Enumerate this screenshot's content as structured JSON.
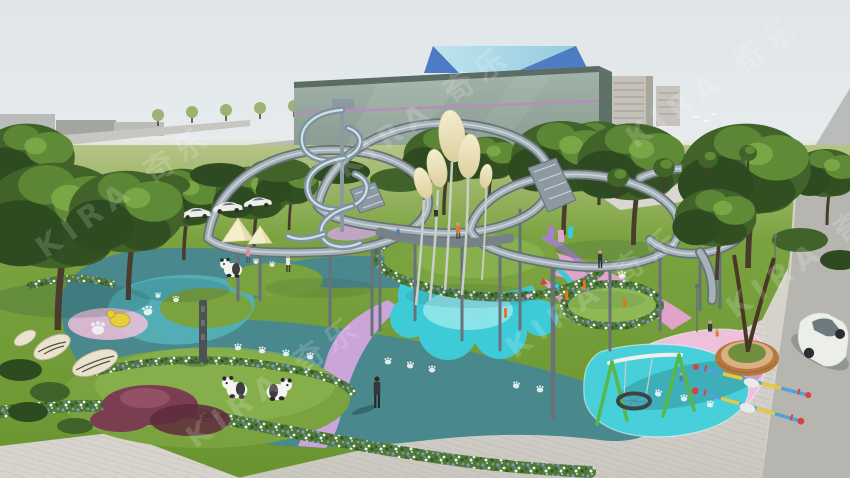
{
  "scene": {
    "type": "3d-architectural-rendering",
    "subject": "Panda-themed children's playground with elevated winding walkways, spiral slide, balloon lamp sculptures and colorful rubber surfacing in front of a green glass building"
  },
  "watermark": {
    "text": "KIRA 奇乐",
    "opacity": 0.16
  },
  "colors": {
    "sky_top": "#dfe5e9",
    "sky_mid": "#edf0ef",
    "sky_horizon": "#f8f7f2",
    "haze": "#dfe3d3",
    "distant_building": "#b9bcb8",
    "distant_dark": "#a2a5a0",
    "lolli": "#9db273",
    "road_grey": "#b7b5b0",
    "road_light": "#c8c6c1",
    "curb": "#e2e0da",
    "tower_grey": "#c4c1ba",
    "tower_dark": "#a8a59d",
    "tower_window": "#93908a",
    "roof_grey": "#b9bcba",
    "roof_brown": "#8a6a55",
    "glass_light": "#a3b5ab",
    "glass_mid": "#86998f",
    "glass_dark": "#6e8177",
    "glass_side": "#5f7268",
    "building_edge": "#5c6b63",
    "stripe_purple": "#b48fb8",
    "crown_light": "#bfe5ef",
    "crown_mid": "#93c9de",
    "crown_dark": "#4d7cc4",
    "grass_far": "#b6c487",
    "grass_main": "#7aa33f",
    "grass_light": "#8fb854",
    "grass_deep": "#69942f",
    "grass_dark": "#567f2c",
    "trunk": "#4a3c2c",
    "tree_dark": "#2e4a20",
    "tree_mid": "#41632a",
    "tree_light": "#5f8a36",
    "tree_bright": "#7fae4a",
    "shrub_purple": "#7b3e50",
    "shrub_purple_dark": "#5e2c3c",
    "shrub_highlight": "#a05a6e",
    "teal_surface": "#49898d",
    "teal_pool": "#53b1b9",
    "teal_dark": "#3c767b",
    "cyan_pad": "#3ecbd8",
    "cyan_light": "#93e6ec",
    "cyan_swing": "#47cfda",
    "pink_area": "#efc0db",
    "pink_deep": "#e5a4d0",
    "lavender": "#cba4da",
    "violet": "#a77fd2",
    "flower_green": "#4f7a36",
    "flower_blue": "#7e96c9",
    "flower_white": "#eef1f4",
    "flower_dark": "#35551f",
    "paver": "#cbc7c1",
    "paver_light": "#dad6d0",
    "paver_line": "#b8b4ae",
    "sidewalk": "#d7d3cd",
    "steel_dark": "#67727a",
    "steel_mid": "#8d99a0",
    "steel_rail": "#a7b2b8",
    "steel_light": "#bcc7cc",
    "slide_hi": "#dce9ee",
    "slide_body": "#7e93a0",
    "deck": "#76828a",
    "cream": "#f4eecd",
    "cream_dark": "#dccf9e",
    "stem": "#c9d0ca",
    "panda_white": "#f4f4f1",
    "panda_black": "#2a2a28",
    "swing_green": "#58b74a",
    "swing_white": "#edf0ec",
    "nest_dark": "#3c4347",
    "nest_web": "#5a89a0",
    "seesaw_blue": "#4fa3d8",
    "seesaw_yellow": "#e6c93e",
    "seesaw_red": "#d5453c",
    "seesaw_white": "#e8ebe8",
    "brick": "#b5793f",
    "brick_dark": "#93602f",
    "brick_top": "#d9b083",
    "planter_green": "#6f8f3f",
    "car_white": "#eceeea",
    "car_glass": "#6f7a80",
    "car_dark": "#3f4346",
    "wheel": "#2c2f31",
    "person_dark": "#34383c",
    "person_orange": "#e07a30",
    "person_blue": "#4a7ec0",
    "person_pink": "#d88aa8",
    "skin": "#c9a189",
    "bollard_orange": "#e2761f",
    "toy_yellow": "#e5cf3a",
    "toy_yellow_dark": "#b59d1e",
    "pole_dark": "#4c5154",
    "pole_face": "#6a7074",
    "leaf_cream": "#e9e2cf",
    "leaf_edge": "#b9ae8e",
    "leaf_vein": "#55513f",
    "paw_white": "#f0f4f4",
    "shadow": "#1e3d40",
    "watermark_color": "#ffffff"
  }
}
